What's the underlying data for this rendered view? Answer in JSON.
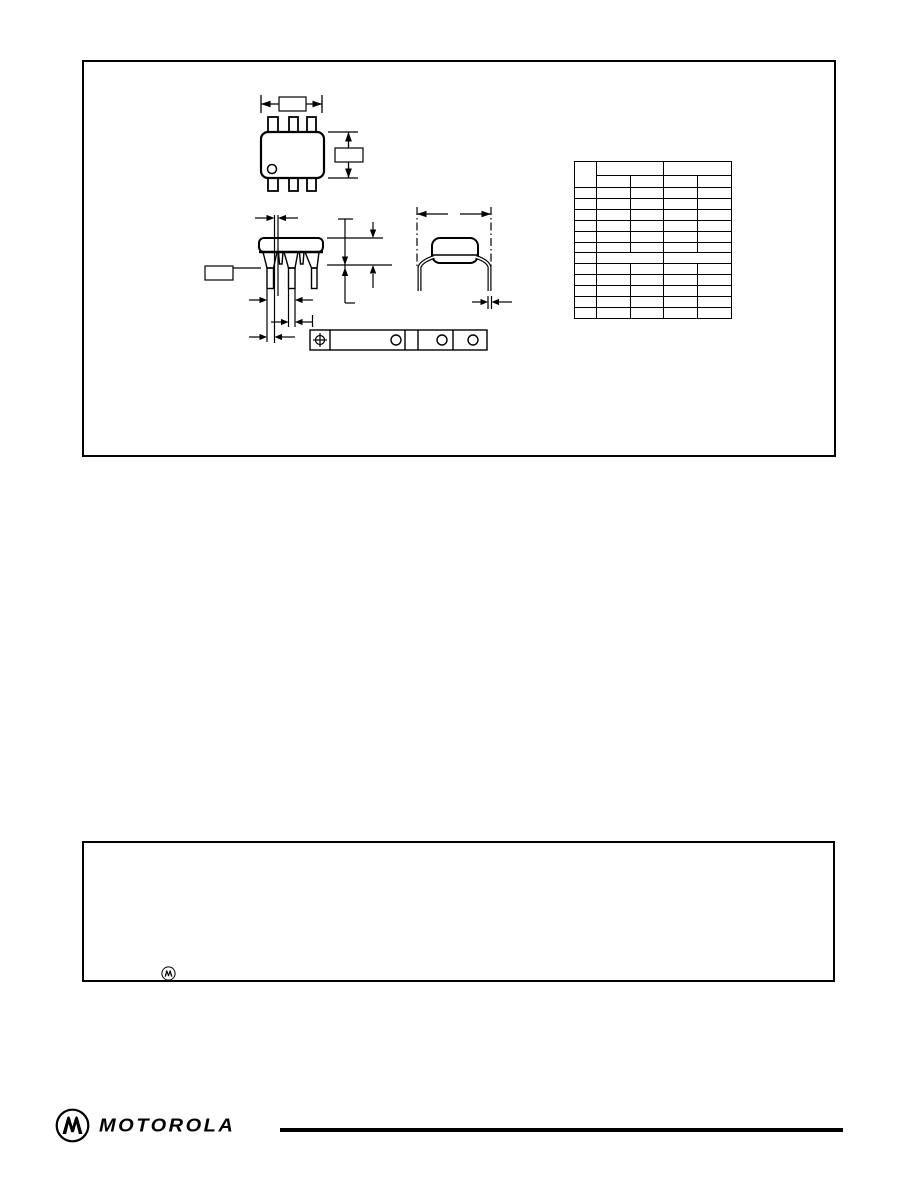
{
  "page": {
    "paper_color": "#ffffff",
    "ink_color": "#000000"
  },
  "drawing_panel": {
    "dimension_labels": {
      "top_view_width_label": "",
      "top_view_height_label": "",
      "front_view_left_label": ""
    },
    "dim_table": {
      "header_row1": [
        "",
        "",
        ""
      ],
      "header_row2": [
        "",
        "",
        "",
        ""
      ],
      "rows": [
        [
          "",
          "",
          "",
          "",
          ""
        ],
        [
          "",
          "",
          "",
          "",
          ""
        ],
        [
          "",
          "",
          "",
          "",
          ""
        ],
        [
          "",
          "",
          "",
          "",
          ""
        ],
        [
          "",
          "",
          "",
          "",
          ""
        ],
        [
          "",
          "",
          "",
          "",
          ""
        ],
        [
          "",
          "",
          ""
        ],
        [
          "",
          "",
          "",
          "",
          ""
        ],
        [
          "",
          "",
          "",
          "",
          ""
        ],
        [
          "",
          "",
          "",
          "",
          ""
        ],
        [
          "",
          "",
          "",
          "",
          ""
        ],
        [
          "",
          "",
          "",
          "",
          ""
        ]
      ],
      "merged_row_indexes": [
        6
      ],
      "column_widths": [
        21,
        33,
        32,
        33,
        33
      ],
      "row_heights": {
        "header1": 13,
        "header2": 11,
        "data": 9.92
      }
    }
  },
  "disclaimer_panel": {
    "text": "",
    "emblem": "motorola-m-in-circle"
  },
  "footer": {
    "brand_wordmark": "MOTOROLA",
    "emblem": "motorola-m-in-circle"
  }
}
